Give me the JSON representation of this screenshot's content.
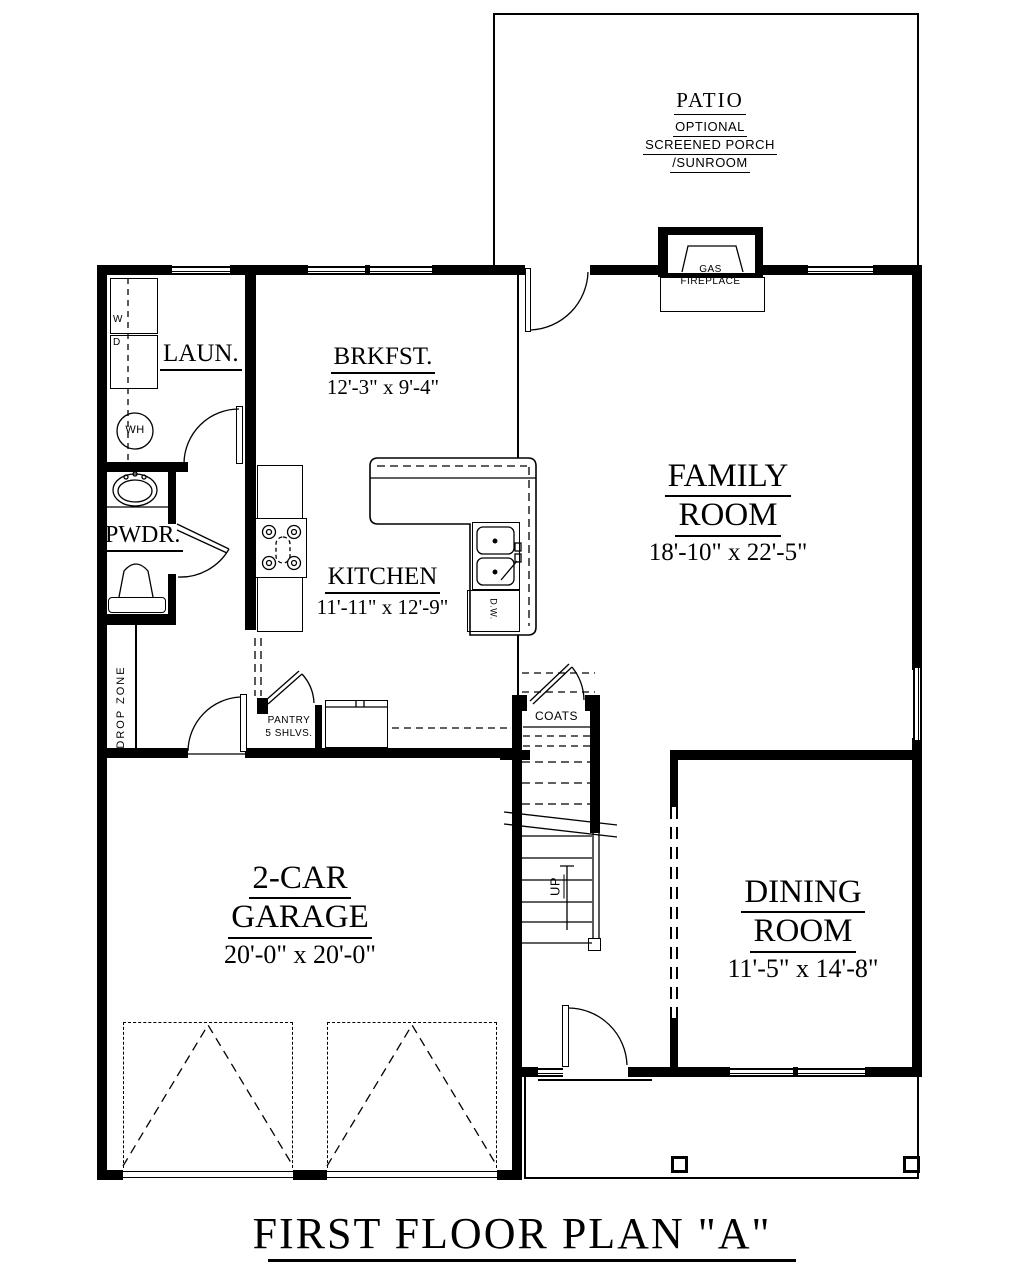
{
  "title": "FIRST FLOOR PLAN \"A\"",
  "colors": {
    "line": "#000000",
    "background": "#ffffff"
  },
  "patio": {
    "name": "PATIO",
    "line1": "OPTIONAL",
    "line2": "SCREENED PORCH",
    "line3": "/SUNROOM"
  },
  "family": {
    "line1": "FAMILY",
    "line2": "ROOM",
    "dims": "18'-10\" x 22'-5\""
  },
  "brkfst": {
    "name": "BRKFST.",
    "dims": "12'-3\" x 9'-4\""
  },
  "kitchen": {
    "name": "KITCHEN",
    "dims": "11'-11\" x 12'-9\""
  },
  "garage": {
    "line1": "2-CAR",
    "line2": "GARAGE",
    "dims": "20'-0\" x 20'-0\""
  },
  "dining": {
    "line1": "DINING",
    "line2": "ROOM",
    "dims": "11'-5\" x 14'-8\""
  },
  "laundry": {
    "name": "LAUN.",
    "washer": "W",
    "dryer": "D",
    "water_heater": "WH"
  },
  "powder": {
    "name": "PWDR."
  },
  "fireplace": {
    "line1": "GAS",
    "line2": "FIREPLACE"
  },
  "pantry": {
    "line1": "PANTRY",
    "line2": "5 SHLVS."
  },
  "closet": {
    "name": "COATS"
  },
  "stairs": {
    "label": "UP"
  },
  "mudroom": {
    "label": "DROP ZONE"
  },
  "island": {
    "dishwasher": "D.W."
  }
}
